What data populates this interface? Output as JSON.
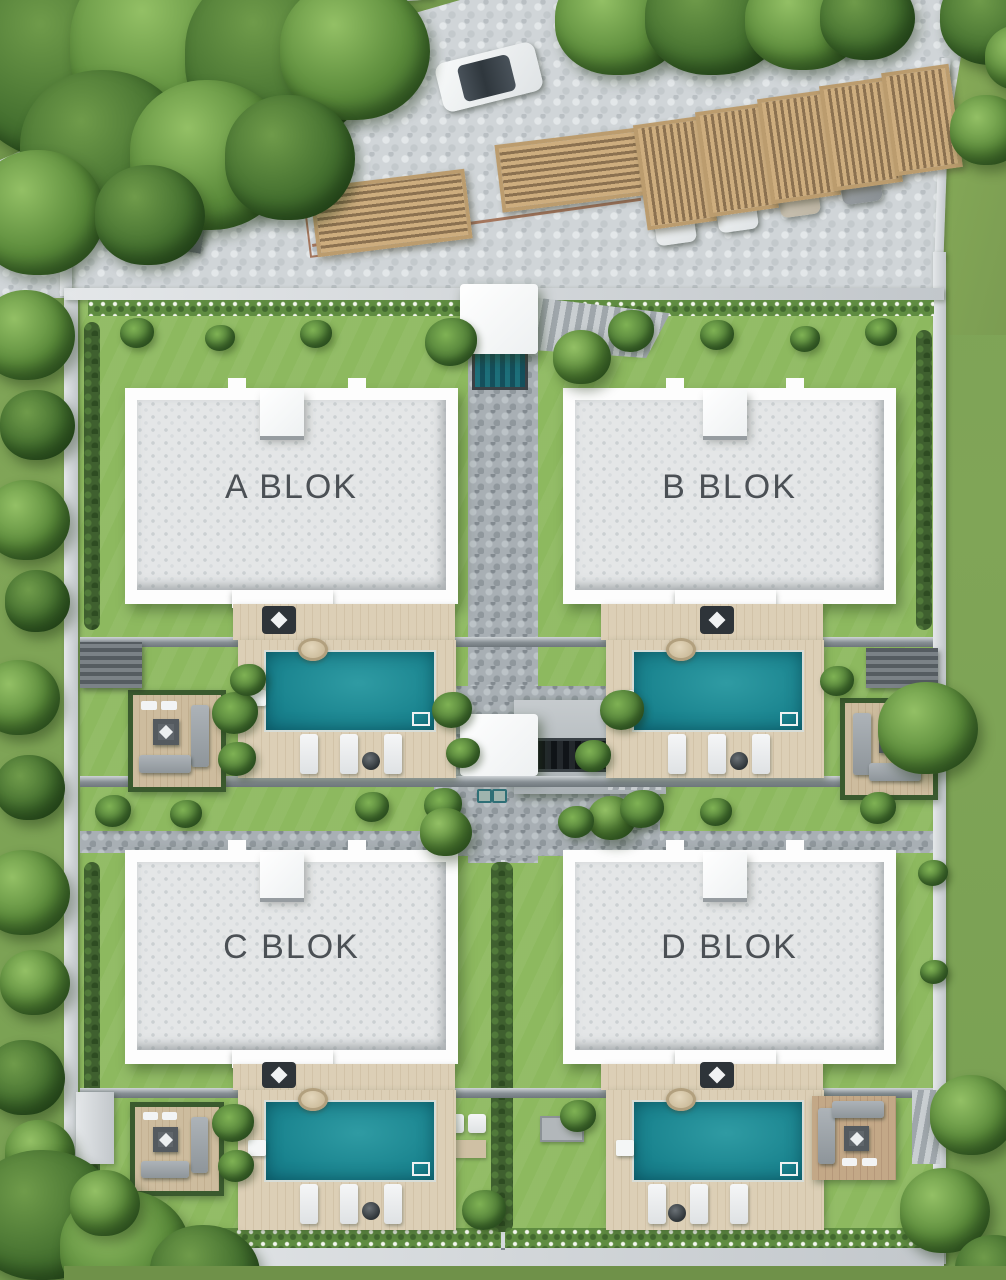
{
  "scene": {
    "type": "architectural-site-plan-3d-render",
    "view": "top-down-aerial",
    "blocks": [
      {
        "label": "A BLOK"
      },
      {
        "label": "B BLOK"
      },
      {
        "label": "C BLOK"
      },
      {
        "label": "D BLOK"
      }
    ],
    "features": {
      "pools": 4,
      "pool_decks": 4,
      "seating_patios": 4,
      "sun_loungers": 12,
      "carport_bays": 7,
      "parked_cars": 5,
      "cars_on_road": 2,
      "central_staircases": 2,
      "hot_tubs": 4
    },
    "colors": {
      "pool_water": "#1a848f",
      "lawn": "#8db95f",
      "outside_grass": "#7da257",
      "roof": "#e4e6e7",
      "building_white": "#fdfdfd",
      "cobblestone_light": "#d0d5d8",
      "cobblestone_dark": "#a8afb4",
      "wood_deck": "#d7cab1",
      "pergola_wood": "#bb9c6e",
      "wall_gray": "#c9ced1",
      "label_text": "#4b5055"
    }
  }
}
